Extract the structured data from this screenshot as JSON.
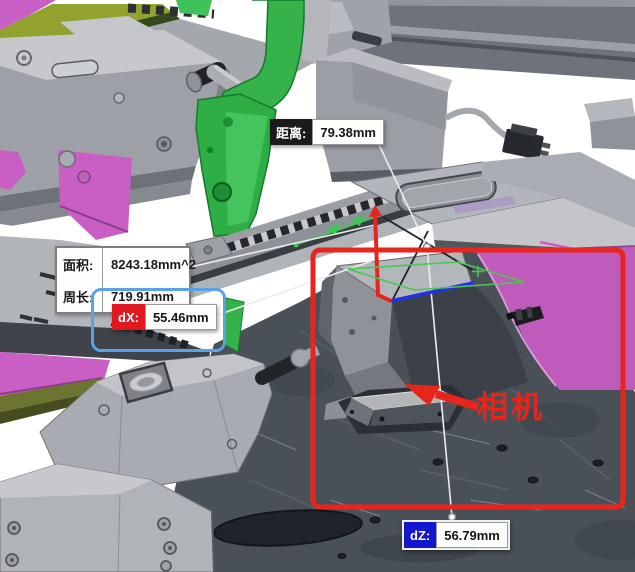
{
  "measurements": {
    "distance": {
      "label": "距离:",
      "value": "79.38mm"
    },
    "area": {
      "label": "面积:",
      "value": "8243.18mm^2"
    },
    "perimeter": {
      "label": "周长:",
      "value": "719.91mm"
    },
    "dx": {
      "label": "dX:",
      "value": "55.46mm"
    },
    "dz": {
      "label": "dZ:",
      "value": "56.79mm"
    }
  },
  "callout": {
    "camera_label": "相机"
  },
  "colors": {
    "annotation_red": "#e8251c",
    "dx_badge_red": "#e0181f",
    "dz_badge_blue": "#1217cf",
    "selection_blue": "#5aa2e8",
    "distance_badge_black": "#1b1b1b",
    "measure_blue_line": "#2330e8",
    "measure_green": "#49c84f",
    "part_green": "#35b24a",
    "part_magenta": "#c95fc5",
    "part_olive": "#93a12f",
    "floor_slate": "#4a5058"
  }
}
